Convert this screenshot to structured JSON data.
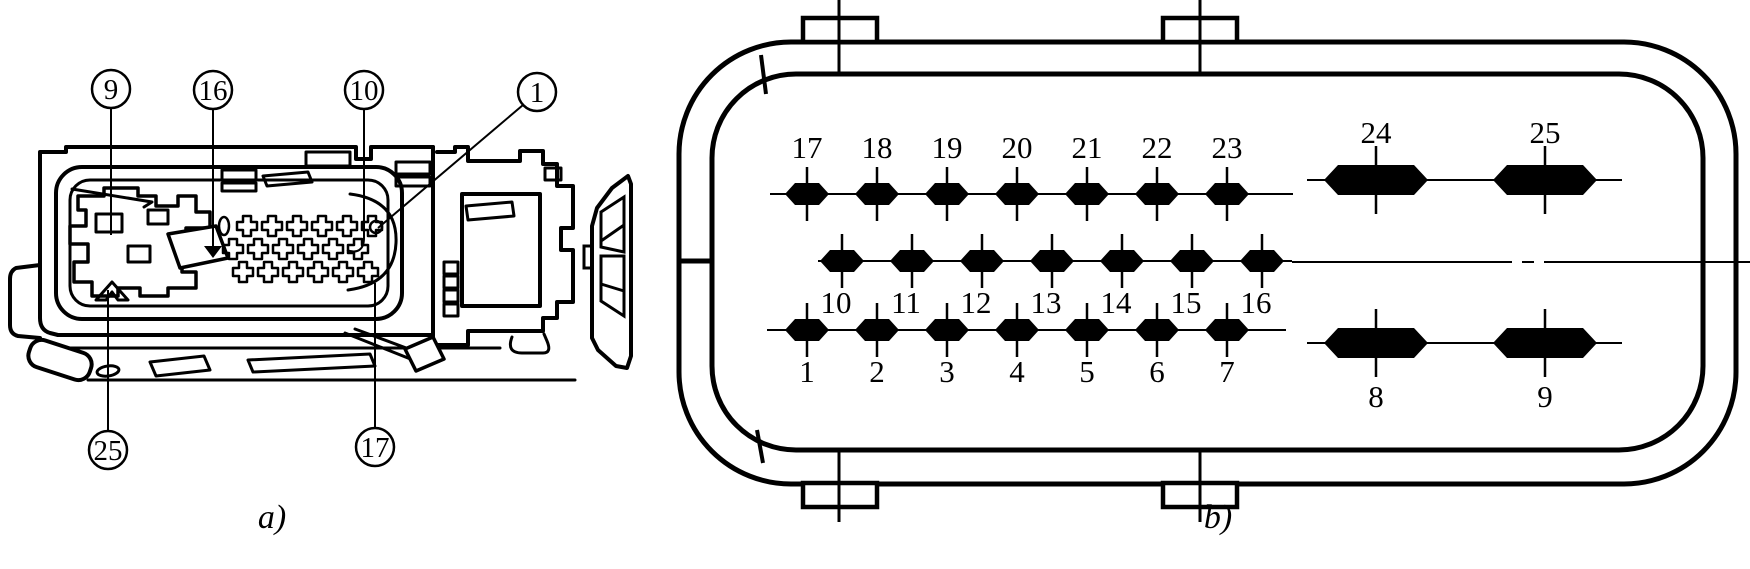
{
  "figure": {
    "caption_a": "a)",
    "caption_b": "b)",
    "ink": "#000000",
    "background": "#ffffff"
  },
  "view_a": {
    "description": "connector-housing-side-view",
    "callouts": [
      {
        "label": "9",
        "cx": 111,
        "cy": 89,
        "leader": [
          [
            111,
            108
          ],
          [
            111,
            235
          ]
        ]
      },
      {
        "label": "16",
        "cx": 213,
        "cy": 90,
        "leader": [
          [
            213,
            109
          ],
          [
            213,
            246
          ]
        ],
        "arrow": [
          213,
          258
        ]
      },
      {
        "label": "10",
        "cx": 364,
        "cy": 90,
        "leader": [
          [
            364,
            109
          ],
          [
            364,
            238
          ]
        ],
        "hook": true
      },
      {
        "label": "1",
        "cx": 537,
        "cy": 92,
        "leader": [
          [
            523,
            105
          ],
          [
            378,
            228
          ]
        ]
      },
      {
        "label": "25",
        "cx": 108,
        "cy": 450,
        "leader": [
          [
            108,
            431
          ],
          [
            108,
            290
          ]
        ]
      },
      {
        "label": "17",
        "cx": 375,
        "cy": 447,
        "leader": [
          [
            375,
            428
          ],
          [
            375,
            283
          ]
        ]
      }
    ]
  },
  "view_b": {
    "description": "connector-face-pinout",
    "pin_rows": [
      {
        "name": "row-top-small",
        "pins": [
          "17",
          "18",
          "19",
          "20",
          "21",
          "22",
          "23"
        ],
        "x0": 807,
        "pitch": 70,
        "y": 194,
        "size": "small",
        "label_side": "above",
        "label_y": 158
      },
      {
        "name": "row-middle-small",
        "pins": [
          "10",
          "11",
          "12",
          "13",
          "14",
          "15",
          "16"
        ],
        "x0": 842,
        "pitch": 70,
        "y": 261,
        "size": "small",
        "label_side": "below",
        "label_y": 313,
        "label_dx": -6
      },
      {
        "name": "row-bottom-small",
        "pins": [
          "1",
          "2",
          "3",
          "4",
          "5",
          "6",
          "7"
        ],
        "x0": 807,
        "pitch": 70,
        "y": 330,
        "size": "small",
        "label_side": "below",
        "label_y": 382
      },
      {
        "name": "row-top-large",
        "pins": [
          "24",
          "25"
        ],
        "x0": 1376,
        "pitch": 169,
        "y": 180,
        "size": "large",
        "label_side": "above",
        "label_y": 143
      },
      {
        "name": "row-bottom-large",
        "pins": [
          "8",
          "9"
        ],
        "x0": 1376,
        "pitch": 169,
        "y": 343,
        "size": "large",
        "label_side": "below",
        "label_y": 407
      }
    ],
    "row_lines": [
      {
        "y": 194,
        "x1": 770,
        "x2": 1293
      },
      {
        "y": 261,
        "x1": 818,
        "x2": 1292
      },
      {
        "y": 330,
        "x1": 767,
        "x2": 1286
      },
      {
        "y": 180,
        "x1": 1307,
        "x2": 1622
      },
      {
        "y": 343,
        "x1": 1307,
        "x2": 1622
      }
    ],
    "centerline": {
      "y": 262,
      "segments": [
        [
          1292,
          1512
        ],
        [
          1522,
          1534
        ],
        [
          1544,
          1750
        ]
      ]
    }
  }
}
